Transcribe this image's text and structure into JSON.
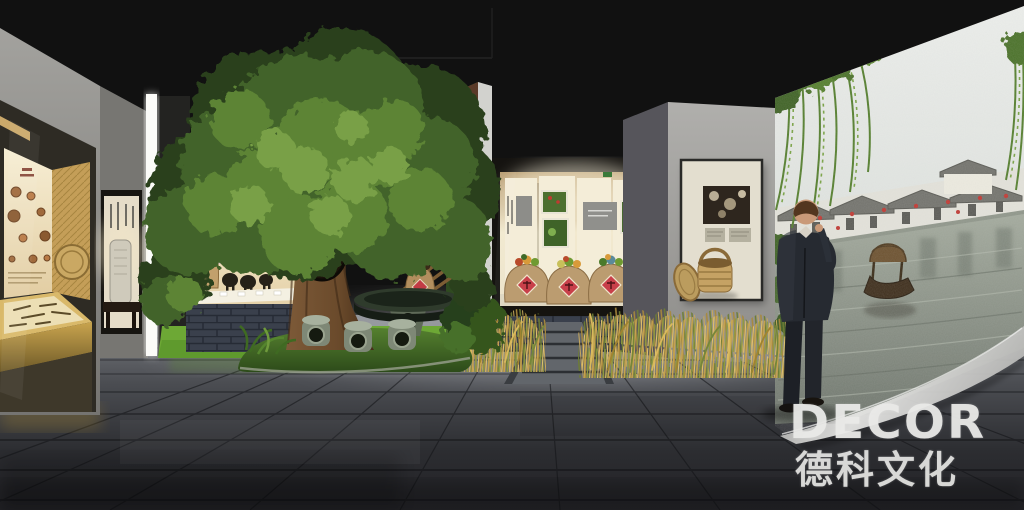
{
  "watermark": {
    "brand": "DECOR",
    "brand_cjk": "德科文化"
  },
  "palette": {
    "ceiling_black": "#111111",
    "wall_gray": "#9a9995",
    "floor_dark": "#26272b",
    "floor_light": "#83868b",
    "display_gold": "#c8a85c",
    "turf_green": "#6fae36",
    "foliage_green": "#4d6f2c",
    "rice_gold": "#c9a44e",
    "jar_label_red": "#c23b45",
    "brick_base": "#3a404c",
    "mural_sky": "#e6e9e6",
    "mural_water": "#8e958c",
    "suit_dark": "#262a31",
    "watermark_white": "#eaeae8"
  }
}
